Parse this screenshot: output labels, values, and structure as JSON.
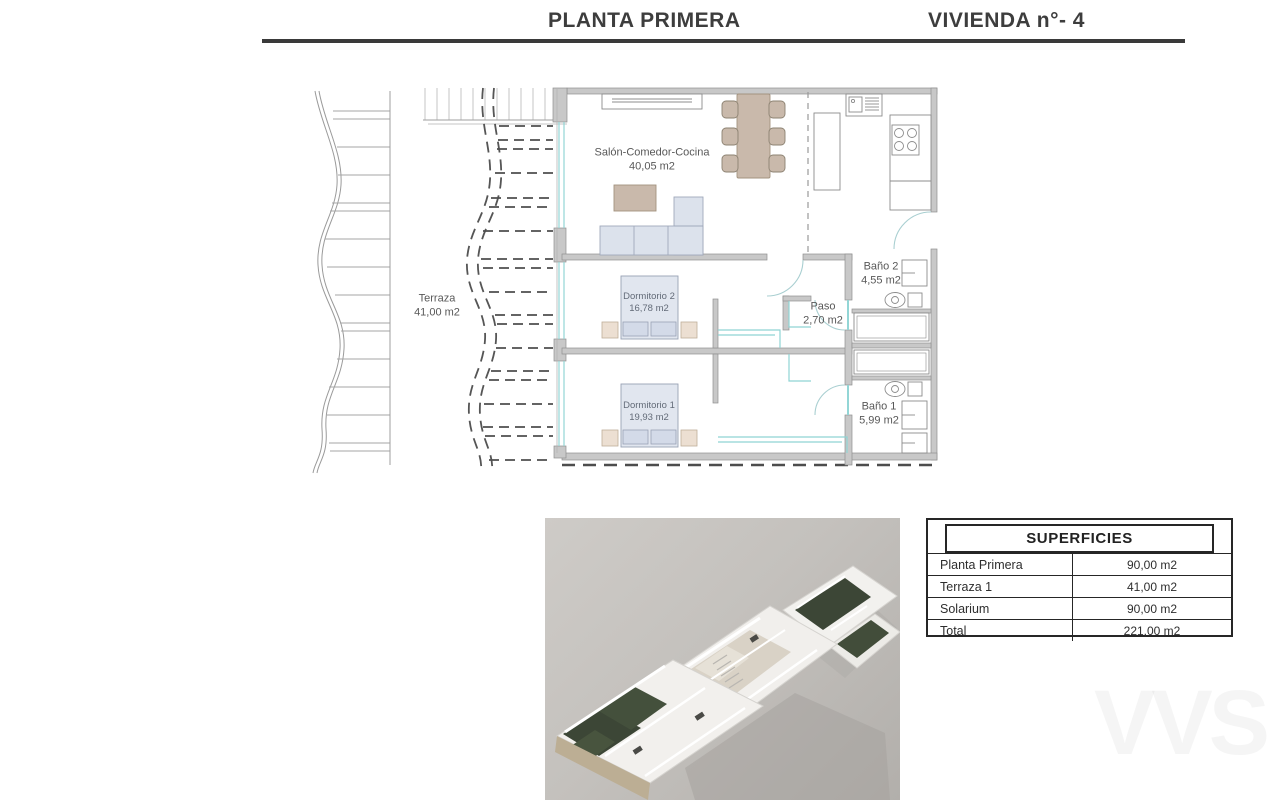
{
  "header": {
    "left_title": "PLANTA PRIMERA",
    "right_title": "VIVIENDA n°- 4"
  },
  "floor_plan": {
    "rooms": [
      {
        "label": "Salón-Comedor-Cocina",
        "area": "40,05 m2"
      },
      {
        "label": "Terraza",
        "area": "41,00 m2"
      },
      {
        "label": "Dormitorio 2",
        "area": "16,78 m2"
      },
      {
        "label": "Dormitorio 1",
        "area": "19,93 m2"
      },
      {
        "label": "Paso",
        "area": "2,70 m2"
      },
      {
        "label": "Baño 2",
        "area": "4,55 m2"
      },
      {
        "label": "Baño 1",
        "area": "5,99 m2"
      }
    ]
  },
  "superficies_table": {
    "title": "SUPERFICIES",
    "rows": [
      {
        "label": "Planta Primera",
        "value": "90,00 m2"
      },
      {
        "label": "Terraza 1",
        "value": "41,00 m2"
      },
      {
        "label": "Solarium",
        "value": "90,00 m2"
      },
      {
        "label": "Total",
        "value": "221,00 m2"
      }
    ]
  },
  "watermark": {
    "text": "VVS"
  },
  "colors": {
    "rule": "#3a3a3a",
    "wall_fill": "#c8c8c8",
    "wall_stroke": "#8f8f8f",
    "window_teal": "#93d6d6",
    "furniture_tan": "#c9b9ab",
    "bed_blue": "#e1e6ef",
    "dashed_dark": "#4d4d4d",
    "terrace_green": "#3c4636",
    "render_bg": "#c4c1bd"
  }
}
